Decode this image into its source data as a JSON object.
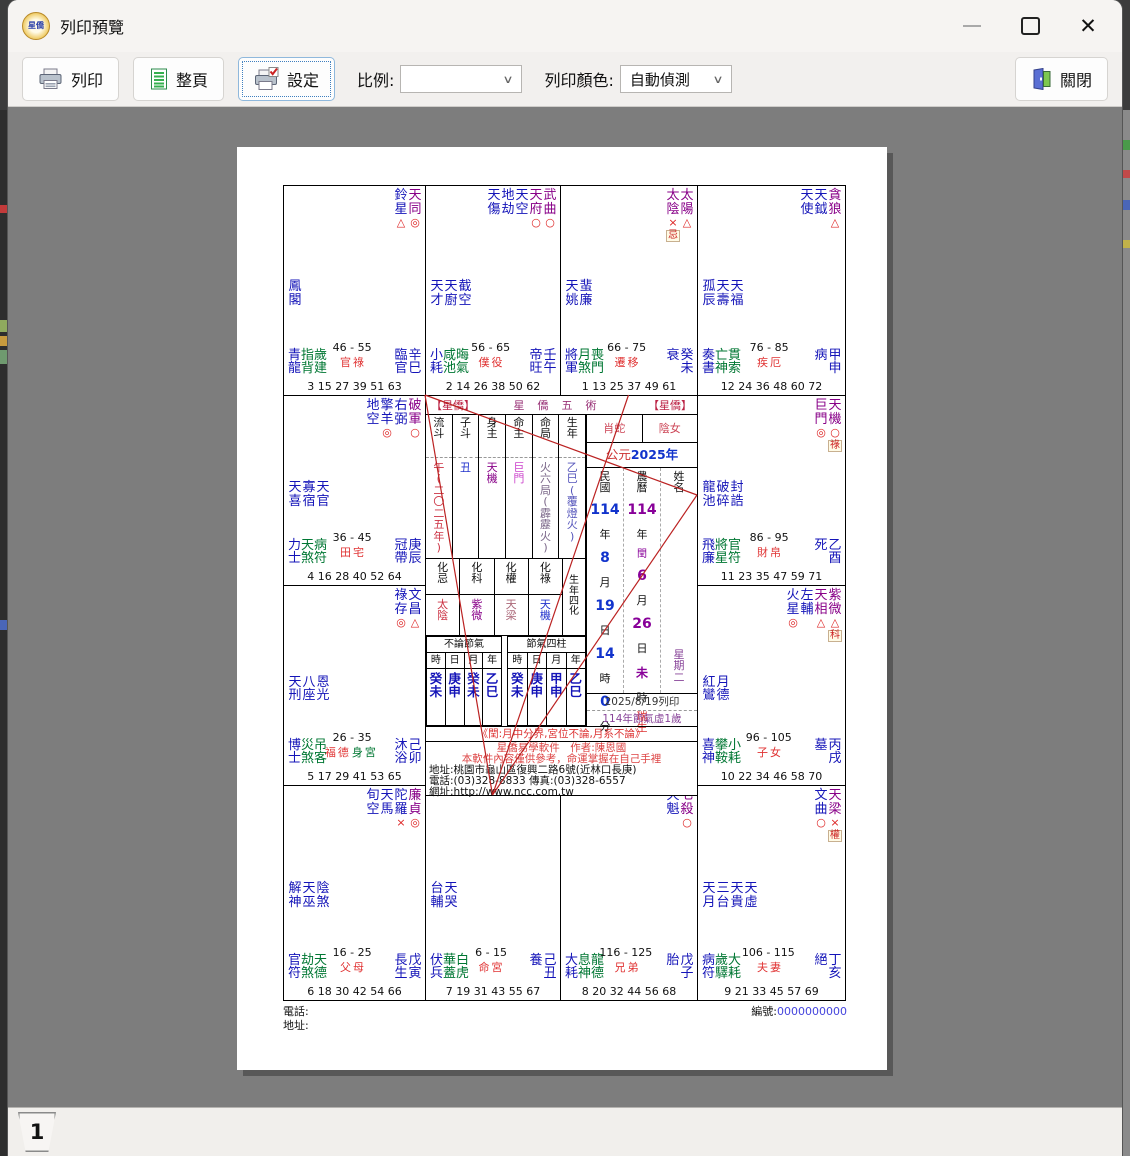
{
  "window": {
    "title": "列印預覽",
    "app_badge_text": "星僑",
    "controls": {
      "minimize_icon": "minimize-icon",
      "maximize_icon": "maximize-icon",
      "close_icon": "close-x-icon"
    }
  },
  "toolbar": {
    "print_label": "列印",
    "full_page_label": "整頁",
    "settings_label": "設定",
    "scale_label": "比例:",
    "scale_value": "",
    "color_label": "列印顏色:",
    "color_value": "自動偵測",
    "close_label": "關閉",
    "icons": [
      "printer-icon",
      "full-page-icon",
      "printer-settings-icon",
      "close-door-icon"
    ]
  },
  "pager": {
    "page_tab": "1"
  },
  "chart": {
    "colors": {
      "major_star": "#880088",
      "minor_star": "#1414b8",
      "aux_green": "#007733",
      "mark_red": "#dd2222",
      "palace_red": "#e03333",
      "line_red": "#bb2222",
      "minguo_blue": "#1133cc",
      "lunar_purple": "#880099"
    },
    "body_palace_label": "身宮",
    "sanfang_lines": [
      [
        209.5,
        610,
        142,
        210
      ],
      [
        209.5,
        610,
        345.5,
        210
      ],
      [
        209.5,
        610,
        414,
        310
      ],
      [
        142,
        210,
        414,
        310
      ]
    ],
    "palaces": [
      {
        "row": 0,
        "col": 0,
        "top": [
          {
            "n": "鈴星",
            "t": "b",
            "m": "△"
          },
          {
            "n": "天同",
            "t": "p",
            "m": "◎"
          }
        ],
        "mid": [
          "鳳閣"
        ],
        "aux": [
          "青龍",
          "指背",
          "歲建"
        ],
        "age": "46 - 55",
        "palace": "官祿",
        "body": false,
        "stage": "臨官",
        "gz": "辛巳",
        "nums": "3 15 27 39 51 63"
      },
      {
        "row": 0,
        "col": 1,
        "top": [
          {
            "n": "天傷",
            "t": "b"
          },
          {
            "n": "地劫",
            "t": "b"
          },
          {
            "n": "天空",
            "t": "b"
          },
          {
            "n": "天府",
            "t": "p",
            "m": "○"
          },
          {
            "n": "武曲",
            "t": "p",
            "m": "○"
          }
        ],
        "mid": [
          "天才",
          "天廚",
          "截空"
        ],
        "aux": [
          "小耗",
          "咸池",
          "晦氣"
        ],
        "age": "56 - 65",
        "palace": "僕役",
        "body": false,
        "stage": "帝旺",
        "gz": "壬午",
        "nums": "2 14 26 38 50 62"
      },
      {
        "row": 0,
        "col": 2,
        "top": [
          {
            "n": "太陰",
            "t": "p",
            "m": "×",
            "hua": "忌"
          },
          {
            "n": "太陽",
            "t": "p",
            "m": "△"
          }
        ],
        "mid": [
          "天姚",
          "蜚廉"
        ],
        "aux": [
          "將軍",
          "月煞",
          "喪門"
        ],
        "age": "66 - 75",
        "palace": "遷移",
        "body": false,
        "stage": "衰",
        "gz": "癸未",
        "nums": "1 13 25 37 49 61"
      },
      {
        "row": 0,
        "col": 3,
        "top": [
          {
            "n": "天使",
            "t": "b"
          },
          {
            "n": "天鉞",
            "t": "b"
          },
          {
            "n": "貪狼",
            "t": "p",
            "m": "△"
          }
        ],
        "mid": [
          "孤辰",
          "天壽",
          "天福"
        ],
        "aux": [
          "奏書",
          "亡神",
          "貫索"
        ],
        "age": "76 - 85",
        "palace": "疾厄",
        "body": false,
        "stage": "病",
        "gz": "甲申",
        "nums": "12 24 36 48 60 72"
      },
      {
        "row": 1,
        "col": 0,
        "top": [
          {
            "n": "地空",
            "t": "b"
          },
          {
            "n": "擎羊",
            "t": "b",
            "m": "◎"
          },
          {
            "n": "右弼",
            "t": "b"
          },
          {
            "n": "破軍",
            "t": "p",
            "m": "○"
          }
        ],
        "mid": [
          "天喜",
          "寡宿",
          "天官"
        ],
        "aux": [
          "力士",
          "天煞",
          "病符"
        ],
        "age": "36 - 45",
        "palace": "田宅",
        "body": false,
        "stage": "冠帶",
        "gz": "庚辰",
        "nums": "4 16 28 40 52 64"
      },
      {
        "row": 1,
        "col": 3,
        "top": [
          {
            "n": "巨門",
            "t": "p",
            "m": "◎"
          },
          {
            "n": "天機",
            "t": "p",
            "m": "○",
            "hua": "祿"
          }
        ],
        "mid": [
          "龍池",
          "破碎",
          "封誥"
        ],
        "aux": [
          "飛廉",
          "將星",
          "官符"
        ],
        "age": "86 - 95",
        "palace": "財帛",
        "body": false,
        "stage": "死",
        "gz": "乙酉",
        "nums": "11 23 35 47 59 71"
      },
      {
        "row": 2,
        "col": 0,
        "top": [
          {
            "n": "祿存",
            "t": "b",
            "m": "◎"
          },
          {
            "n": "文昌",
            "t": "b",
            "m": "△"
          }
        ],
        "mid": [
          "天刑",
          "八座",
          "恩光"
        ],
        "aux": [
          "博士",
          "災煞",
          "吊客"
        ],
        "age": "26 - 35",
        "palace": "福德",
        "body": true,
        "stage": "沐浴",
        "gz": "己卯",
        "nums": "5 17 29 41 53 65"
      },
      {
        "row": 2,
        "col": 3,
        "top": [
          {
            "n": "火星",
            "t": "b",
            "m": "◎"
          },
          {
            "n": "左輔",
            "t": "b"
          },
          {
            "n": "天相",
            "t": "p",
            "m": "△"
          },
          {
            "n": "紫微",
            "t": "p",
            "m": "△",
            "hua": "科"
          }
        ],
        "mid": [
          "紅鸞",
          "月德"
        ],
        "aux": [
          "喜神",
          "攀鞍",
          "小耗"
        ],
        "age": "96 - 105",
        "palace": "子女",
        "body": false,
        "stage": "墓",
        "gz": "丙戌",
        "nums": "10 22 34 46 58 70"
      },
      {
        "row": 3,
        "col": 0,
        "top": [
          {
            "n": "旬空",
            "t": "b"
          },
          {
            "n": "天馬",
            "t": "b"
          },
          {
            "n": "陀羅",
            "t": "b",
            "m": "×"
          },
          {
            "n": "廉貞",
            "t": "p",
            "m": "◎"
          }
        ],
        "mid": [
          "解神",
          "天巫",
          "陰煞"
        ],
        "aux": [
          "官符",
          "劫煞",
          "天德"
        ],
        "age": "16 - 25",
        "palace": "父母",
        "body": false,
        "stage": "長生",
        "gz": "戊寅",
        "nums": "6 18 30 42 54 66"
      },
      {
        "row": 3,
        "col": 1,
        "top": [],
        "mid": [
          "台輔",
          "天哭"
        ],
        "aux": [
          "伏兵",
          "華蓋",
          "白虎"
        ],
        "age": "6 - 15",
        "palace": "命宮",
        "body": false,
        "stage": "養",
        "gz": "己丑",
        "nums": "7 19 31 43 55 67"
      },
      {
        "row": 3,
        "col": 2,
        "top": [
          {
            "n": "天魁",
            "t": "b"
          },
          {
            "n": "七殺",
            "t": "p",
            "m": "○"
          }
        ],
        "mid": [],
        "aux": [
          "大耗",
          "息神",
          "龍德"
        ],
        "age": "116 - 125",
        "palace": "兄弟",
        "body": false,
        "stage": "胎",
        "gz": "戊子",
        "nums": "8 20 32 44 56 68"
      },
      {
        "row": 3,
        "col": 3,
        "top": [
          {
            "n": "文曲",
            "t": "b",
            "m": "○"
          },
          {
            "n": "天梁",
            "t": "p",
            "m": "×",
            "hua": "權"
          }
        ],
        "mid": [
          "天月",
          "三台",
          "天貴",
          "天虛"
        ],
        "aux": [
          "病符",
          "歲驛",
          "大耗"
        ],
        "age": "106 - 115",
        "palace": "夫妻",
        "body": false,
        "stage": "絕",
        "gz": "丁亥",
        "nums": "9 21 33 45 57 69"
      }
    ],
    "center": {
      "brand_left": "【星僑】",
      "brand_center": "星僑五術",
      "brand_right": "【星僑】",
      "star_info": {
        "columns": [
          {
            "label": "流斗",
            "value": "午(二〇二五年)",
            "color": "#cc3344"
          },
          {
            "label": "子斗",
            "value": "丑",
            "color": "#2233cc"
          },
          {
            "label": "身主",
            "value": "天機",
            "color": "#880088"
          },
          {
            "label": "命主",
            "value": "巨門",
            "color": "#cc44cc"
          },
          {
            "label": "命局",
            "value": "火六局(霹靂火)",
            "color": "#7a6688"
          },
          {
            "label": "生年",
            "value": "乙巳(覆燈火)",
            "color": "#5555bb"
          }
        ]
      },
      "si_hua": {
        "title": "生年四化",
        "columns": [
          {
            "label": "化忌",
            "value": "太陰",
            "color": "#cc3344"
          },
          {
            "label": "化科",
            "value": "紫微",
            "color": "#880088"
          },
          {
            "label": "化權",
            "value": "天梁",
            "color": "#aa6677"
          },
          {
            "label": "化祿",
            "value": "天機",
            "color": "#2233cc"
          }
        ]
      },
      "pillars_no_term": {
        "title": "不論節氣",
        "headers": [
          "時",
          "日",
          "月",
          "年"
        ],
        "values": [
          "癸未",
          "庚申",
          "癸未",
          "乙巳"
        ]
      },
      "pillars_term": {
        "title": "節氣四柱",
        "headers": [
          "時",
          "日",
          "月",
          "年"
        ],
        "values": [
          "癸未",
          "庚申",
          "甲申",
          "乙巳"
        ]
      },
      "zodiac": "肖蛇",
      "gender": "陰女",
      "gregorian_prefix": "公元",
      "gregorian_year": "2025年",
      "date_table": {
        "headers": [
          "民國",
          "農曆",
          "姓名"
        ],
        "minguo_items": [
          {
            "t": "114",
            "k": "num"
          },
          {
            "t": "年",
            "k": "lab"
          },
          {
            "t": "8",
            "k": "num"
          },
          {
            "t": "月",
            "k": "lab"
          },
          {
            "t": "19",
            "k": "num"
          },
          {
            "t": "日",
            "k": "lab"
          },
          {
            "t": "14",
            "k": "num"
          },
          {
            "t": "時",
            "k": "lab"
          },
          {
            "t": "0",
            "k": "num"
          },
          {
            "t": "分",
            "k": "lab"
          }
        ],
        "lunar_items": [
          {
            "t": "114",
            "k": "lnum"
          },
          {
            "t": "年",
            "k": "lab"
          },
          {
            "t": "閏",
            "k": "leap"
          },
          {
            "t": "6",
            "k": "lnum"
          },
          {
            "t": "月",
            "k": "lab"
          },
          {
            "t": "26",
            "k": "lnum"
          },
          {
            "t": "日",
            "k": "lab"
          },
          {
            "t": "未",
            "k": "lchar"
          },
          {
            "t": "時",
            "k": "lab"
          }
        ],
        "lunar_note": "瑞生",
        "weekday": "星期二",
        "print_date": "2025/8/19列印",
        "age_note": "114年節氣虛1歲"
      },
      "note_red": "《閏:月中分界,宮位不論,月系不論》",
      "footer_lines": [
        {
          "text": "星僑易學軟件　作者:陳恩國",
          "color": "red",
          "align": "center"
        },
        {
          "text": "本軟件內容僅供參考，命運掌握在自己手裡",
          "color": "red",
          "align": "center"
        },
        {
          "text": "地址:桃園市龜山區復興二路6號(近林口長庚)",
          "color": "black",
          "align": "left"
        },
        {
          "text": "電話:(03)328-8833 傳真:(03)328-6557",
          "color": "black",
          "align": "left"
        },
        {
          "text": "網址:http://www.ncc.com.tw",
          "color": "black",
          "align": "left"
        }
      ]
    },
    "page_footer": {
      "phone_label": "電話:",
      "address_label": "地址:",
      "serial_label": "編號:",
      "serial_value": "0000000000"
    }
  }
}
